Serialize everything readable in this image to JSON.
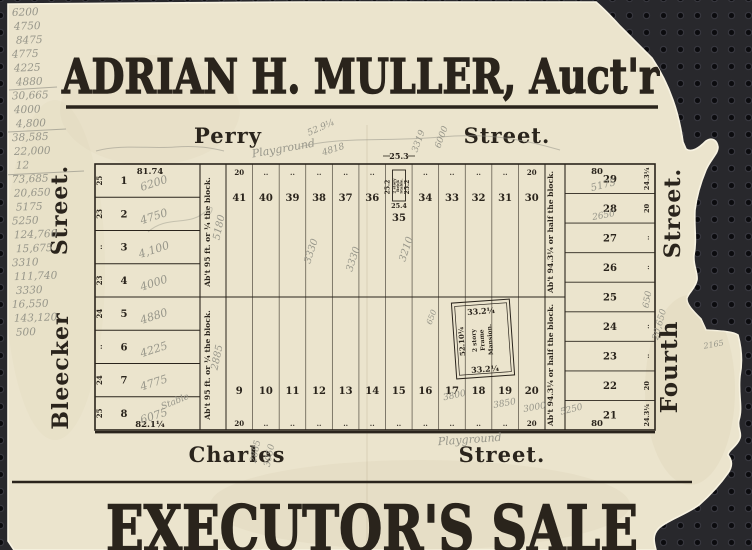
{
  "scan": {
    "colors": {
      "paper": "#ebe4cd",
      "ink": "#2a241c",
      "pencil": "#97968a",
      "board": "#28282c",
      "board_hole": "#0b0b0e"
    },
    "header_title": "ADRIAN H. MULLER, Auct'r",
    "footer_title": "EXECUTOR'S SALE",
    "streets": {
      "top": [
        "Perry",
        "Street."
      ],
      "bottom": [
        "Charles",
        "Street."
      ],
      "left": [
        "Bleecker",
        "Street."
      ],
      "right": [
        "Fourth",
        "Street."
      ]
    },
    "margin_figures": [
      "6200",
      "4750",
      "8475",
      "4775",
      "4225",
      "4880",
      "30,665",
      "4000",
      "4,800",
      "38,585",
      "22,000",
      "12",
      "73,685",
      "20,650",
      "5175",
      "5250",
      "124,760",
      "15,675",
      "3310",
      "111,740",
      "3330",
      "16,550",
      "143,120",
      "500"
    ],
    "map": {
      "left_block": {
        "top_dimension": "81.74",
        "bottom_dimension": "82.1¼",
        "strip_label": "Ab't 95 ft. or ¼ the block.",
        "lots": [
          {
            "number": "1",
            "width": "25",
            "pencil": "6200"
          },
          {
            "number": "2",
            "width": "23",
            "pencil": "4750"
          },
          {
            "number": "3",
            "width": "..",
            "pencil": "4,100"
          },
          {
            "number": "4",
            "width": "23",
            "pencil": "4000"
          },
          {
            "number": "5",
            "width": "24",
            "pencil": "4880"
          },
          {
            "number": "6",
            "width": "..",
            "pencil": "4225"
          },
          {
            "number": "7",
            "width": "24",
            "pencil": "4775"
          },
          {
            "number": "8",
            "width": "25",
            "pencil": "6075"
          }
        ]
      },
      "top_row": {
        "tick_left": "20",
        "tick_right": "20",
        "ditto": "..",
        "lots_left": [
          "41",
          "40",
          "39",
          "38",
          "37",
          "36"
        ],
        "lots_right": [
          "34",
          "33",
          "32",
          "31",
          "30"
        ]
      },
      "stable": {
        "dimension_above": "25.3",
        "side_left": "25.2",
        "side_right": "25.2",
        "building_lines": [
          "2 story",
          "Brick",
          "Stable."
        ],
        "dimension_below": "25.4",
        "lot": "35"
      },
      "bottom_row": {
        "tick_left": "20",
        "tick_right": "20",
        "ditto": "..",
        "lots": [
          "9",
          "10",
          "11",
          "12",
          "13",
          "14",
          "15",
          "16",
          "17",
          "18",
          "19",
          "20"
        ]
      },
      "right_block": {
        "top_dimension": "80",
        "bottom_dimension": "80",
        "strip_label": "Ab't 94.3¼ or half the block.",
        "lots": [
          {
            "number": "29",
            "width": "24.3¼"
          },
          {
            "number": "28",
            "width": "20"
          },
          {
            "number": "27",
            "width": ".."
          },
          {
            "number": "26",
            "width": ".."
          },
          {
            "number": "25",
            "width": ".."
          },
          {
            "number": "24",
            "width": ".."
          },
          {
            "number": "23",
            "width": ".."
          },
          {
            "number": "22",
            "width": "20"
          },
          {
            "number": "21",
            "width": "24.3¼"
          }
        ]
      },
      "mansion": {
        "top": "33.2¼",
        "side": "52.10¼",
        "building_lines": [
          "2 story",
          "Frame",
          "Mansion."
        ],
        "bottom": "33.2¼"
      }
    },
    "pencil_notes": [
      {
        "text": "Playground",
        "x": 284,
        "y": 152,
        "r": -10,
        "s": 11
      },
      {
        "text": "52.9¼",
        "x": 322,
        "y": 130,
        "r": -24,
        "s": 9
      },
      {
        "text": "4818",
        "x": 334,
        "y": 152,
        "r": -18,
        "s": 9
      },
      {
        "text": "3319",
        "x": 421,
        "y": 142,
        "r": -70,
        "s": 9
      },
      {
        "text": "6000",
        "x": 444,
        "y": 138,
        "r": -70,
        "s": 9
      },
      {
        "text": "5180",
        "x": 222,
        "y": 228,
        "r": -78,
        "s": 10
      },
      {
        "text": "2885",
        "x": 220,
        "y": 358,
        "r": -78,
        "s": 10
      },
      {
        "text": "3330",
        "x": 314,
        "y": 252,
        "r": -72,
        "s": 10
      },
      {
        "text": "3330",
        "x": 356,
        "y": 260,
        "r": -72,
        "s": 10
      },
      {
        "text": "3210",
        "x": 409,
        "y": 250,
        "r": -72,
        "s": 10
      },
      {
        "text": "650",
        "x": 434,
        "y": 318,
        "r": -70,
        "s": 8
      },
      {
        "text": "5175",
        "x": 604,
        "y": 188,
        "r": -14,
        "s": 10
      },
      {
        "text": "2650",
        "x": 604,
        "y": 218,
        "r": -10,
        "s": 9
      },
      {
        "text": "650",
        "x": 650,
        "y": 300,
        "r": -80,
        "s": 9
      },
      {
        "text": "20,650",
        "x": 662,
        "y": 325,
        "r": -75,
        "s": 9
      },
      {
        "text": "2252",
        "x": 718,
        "y": 325,
        "r": -10,
        "s": 8
      },
      {
        "text": "2165",
        "x": 714,
        "y": 347,
        "r": -10,
        "s": 8
      },
      {
        "text": "3800",
        "x": 455,
        "y": 398,
        "r": -12,
        "s": 9
      },
      {
        "text": "3850",
        "x": 505,
        "y": 406,
        "r": -10,
        "s": 9
      },
      {
        "text": "3000",
        "x": 535,
        "y": 410,
        "r": -10,
        "s": 9
      },
      {
        "text": "5250",
        "x": 572,
        "y": 412,
        "r": -14,
        "s": 9
      },
      {
        "text": "Stable",
        "x": 176,
        "y": 404,
        "r": -22,
        "s": 9
      },
      {
        "text": "2885",
        "x": 258,
        "y": 452,
        "r": -78,
        "s": 9
      },
      {
        "text": "3050",
        "x": 272,
        "y": 456,
        "r": -78,
        "s": 9
      },
      {
        "text": "Playground",
        "x": 470,
        "y": 443,
        "r": -4,
        "s": 11
      }
    ]
  }
}
